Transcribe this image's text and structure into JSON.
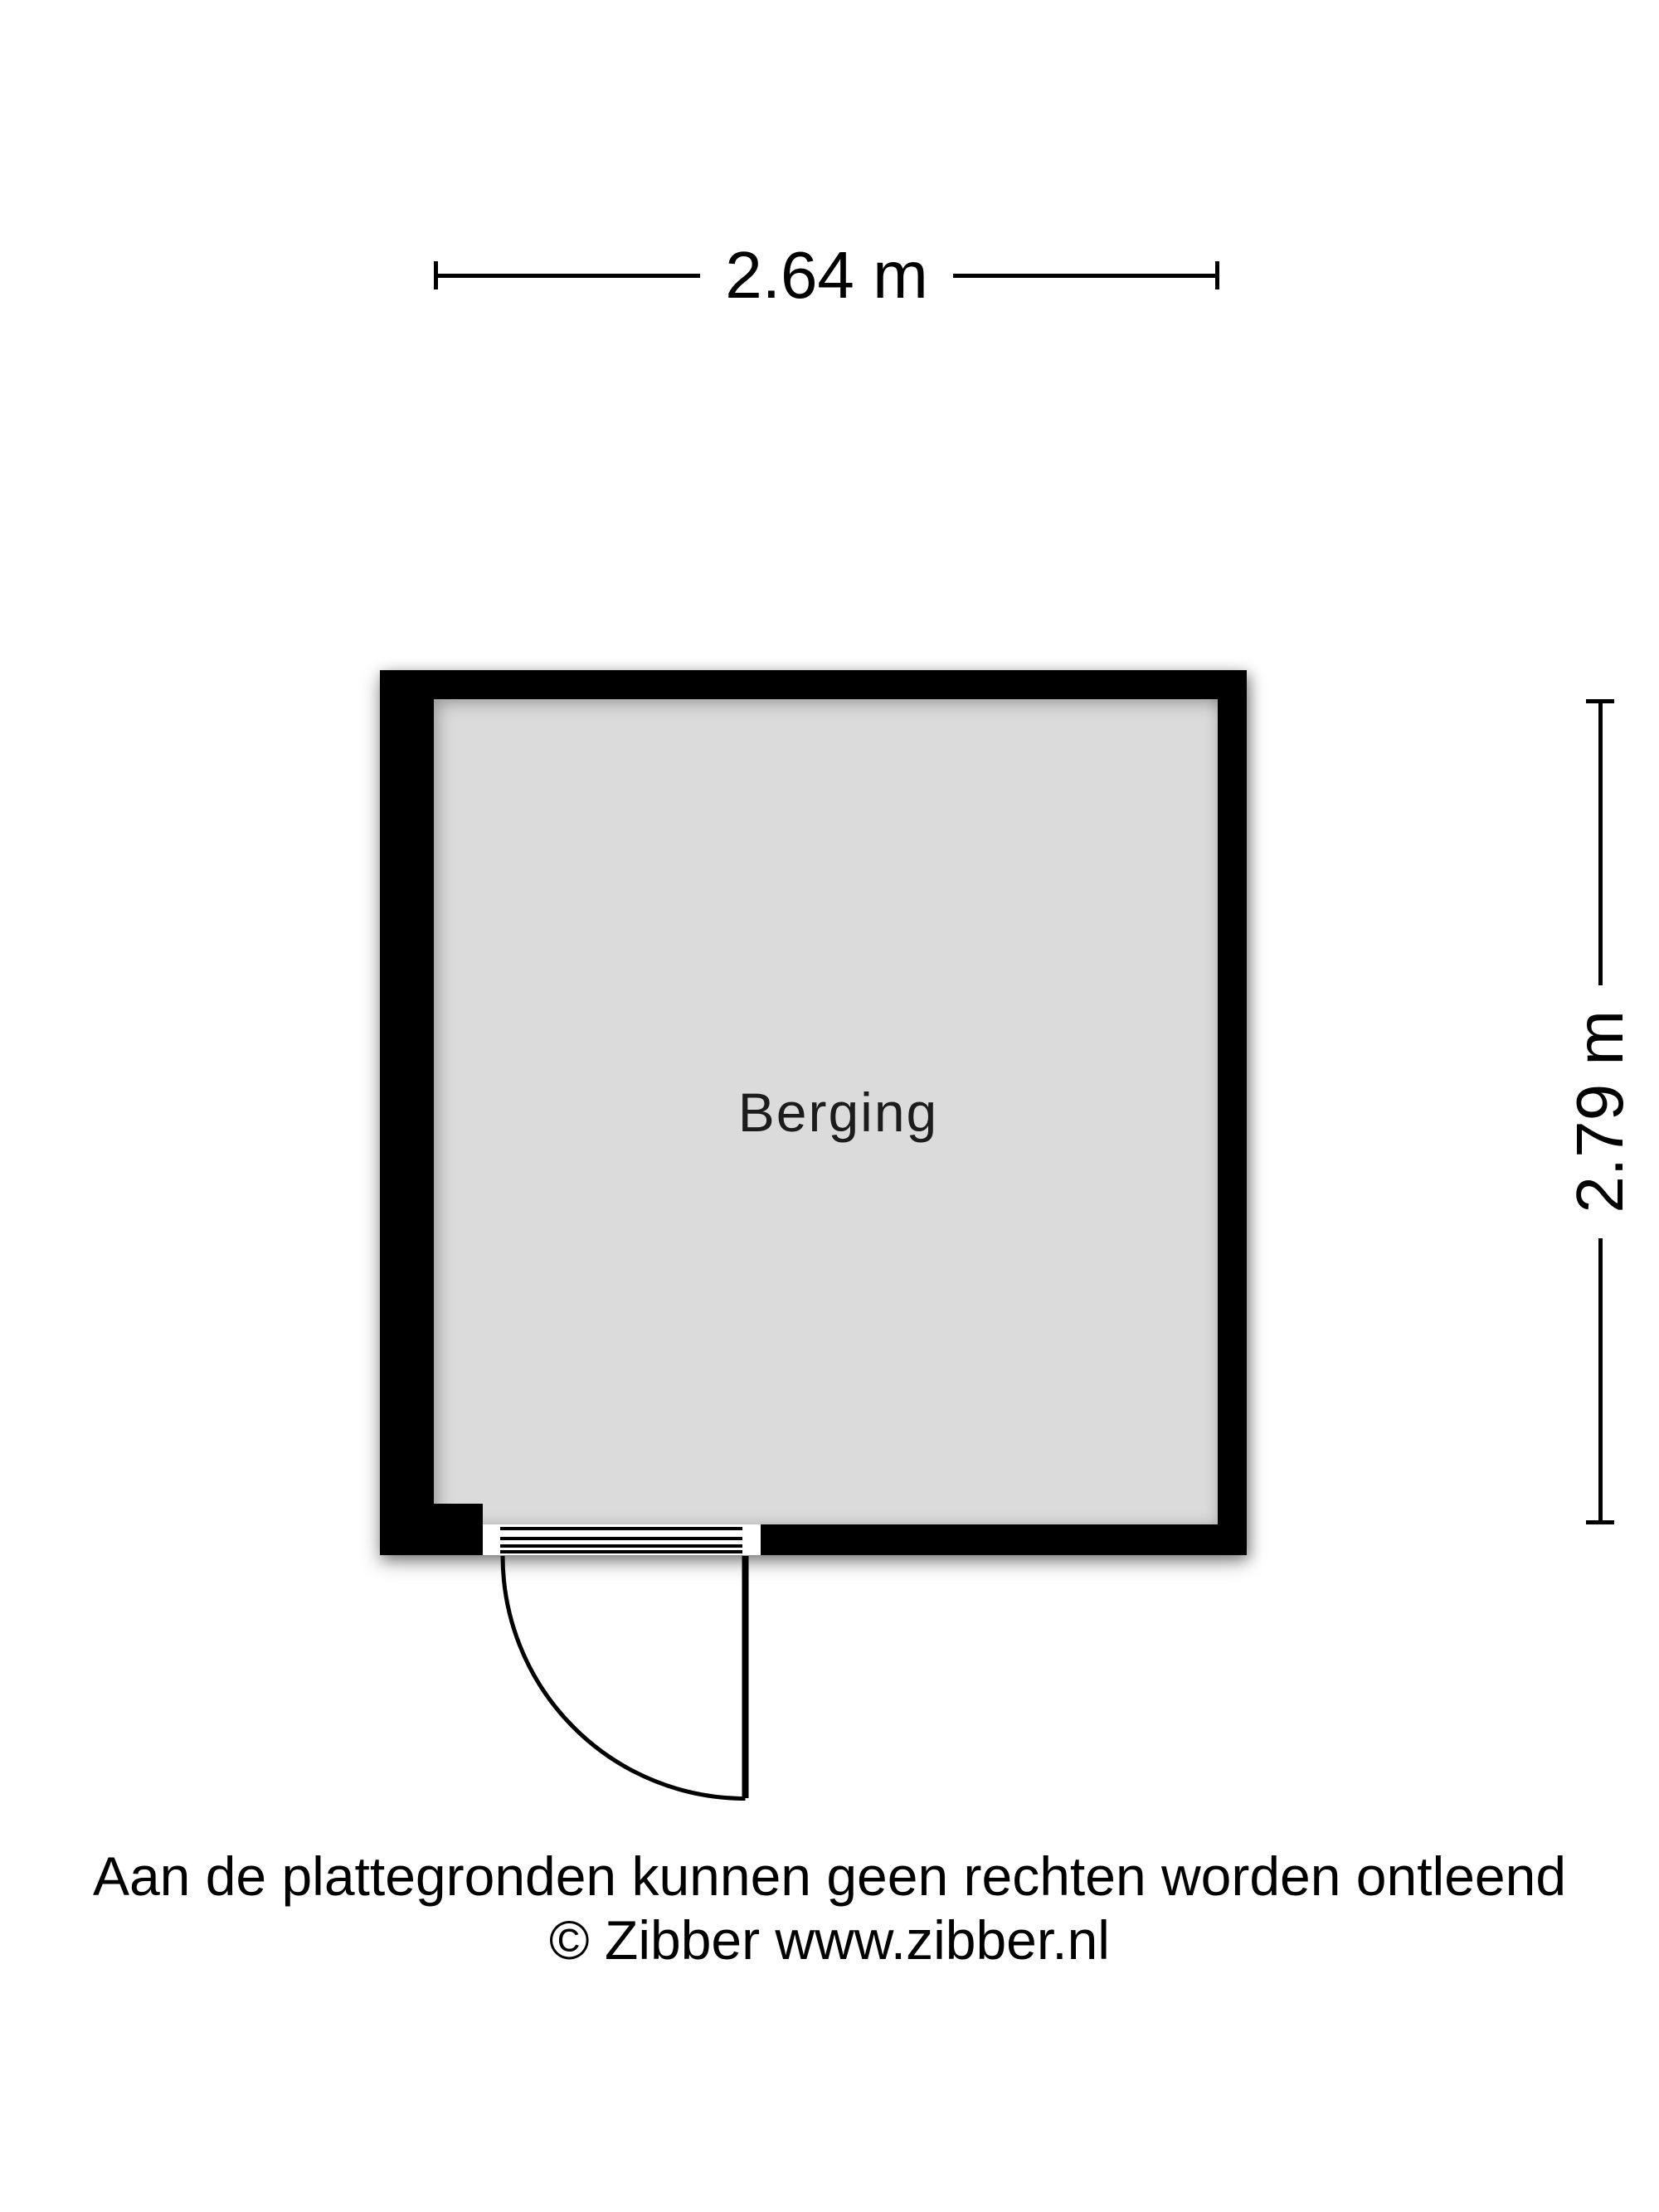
{
  "floorplan": {
    "room_label": "Berging",
    "width_label": "2.64 m",
    "height_label": "2.79 m"
  },
  "footer": {
    "disclaimer": "Aan de plattegronden kunnen geen rechten worden ontleend",
    "copyright": "© Zibber www.zibber.nl"
  },
  "colors": {
    "wall": "#000000",
    "floor": "#dbdbdb",
    "background": "#ffffff"
  }
}
